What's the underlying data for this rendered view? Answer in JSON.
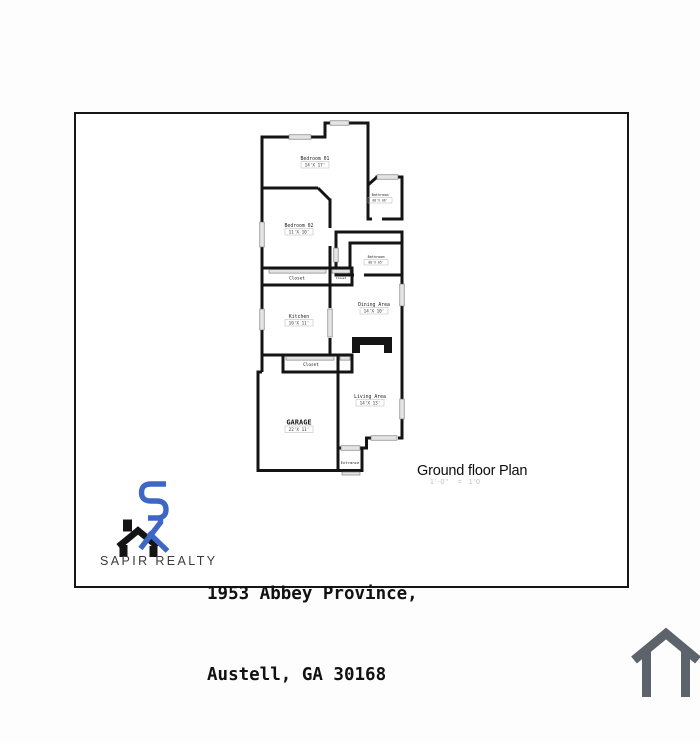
{
  "plan": {
    "title": "Ground floor Plan",
    "scale": "1'-0\"   =  1'0"
  },
  "rooms": {
    "bedroom01": {
      "name": "Bedroom 01",
      "dims": "14'X 17'"
    },
    "bedroom02": {
      "name": "Bedroom 02",
      "dims": "11'X 10'"
    },
    "bathroom1": {
      "name": "Bathroom",
      "dims": "08'X 06'"
    },
    "bathroom2": {
      "name": "Bathroom",
      "dims": "08'X 05'"
    },
    "closet1": {
      "name": "Closet"
    },
    "closet1b": {
      "name": "Closet"
    },
    "closet2": {
      "name": "Closet"
    },
    "kitchen": {
      "name": "Kitchen",
      "dims": "10'X 11'"
    },
    "dining": {
      "name": "Dining Area",
      "dims": "14'X 10'"
    },
    "living": {
      "name": "Living Area",
      "dims": "14'X 13'"
    },
    "garage": {
      "name": "GARAGE",
      "dims": "22'X 11'"
    },
    "entrance": {
      "name": "Entrance"
    }
  },
  "branding": {
    "company": "SAPIR REALTY"
  },
  "address": {
    "line1": "1953 Abbey Province,",
    "line2": "Austell, GA 30168"
  },
  "colors": {
    "wall": "#141414",
    "window_fill": "#e4e4e4",
    "logo_blue": "#3e66c4",
    "logo_black": "#141414",
    "watermark_gray": "#5c636a"
  },
  "icons": {
    "logo": "sapir-sr-house-logo",
    "watermark": "house-outline-icon"
  }
}
